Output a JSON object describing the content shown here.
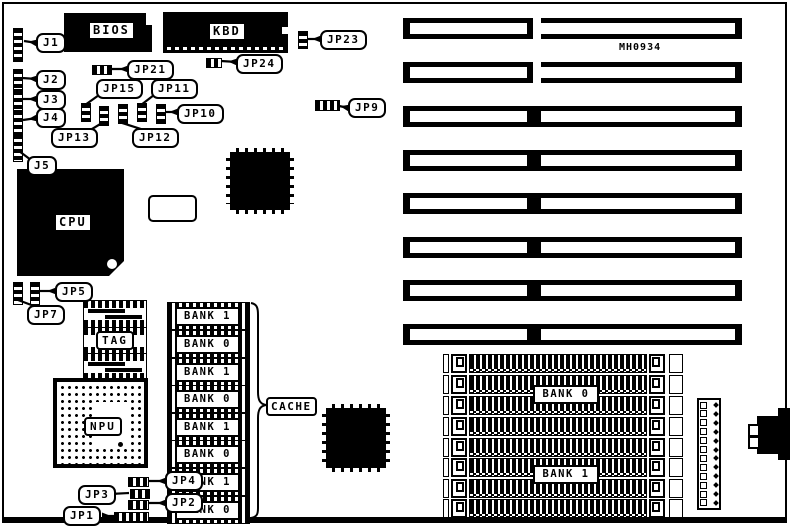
{
  "board": {
    "part_number": "MH0934"
  },
  "chips": {
    "bios": "BIOS",
    "kbd": "KBD",
    "cpu": "CPU",
    "npu": "NPU",
    "tag": "TAG",
    "cache_label": "CACHE"
  },
  "callouts": {
    "j1": "J1",
    "j2": "J2",
    "j3": "J3",
    "j4": "J4",
    "j5": "J5",
    "jp1": "JP1",
    "jp2": "JP2",
    "jp3": "JP3",
    "jp4": "JP4",
    "jp5": "JP5",
    "jp7": "JP7",
    "jp9": "JP9",
    "jp10": "JP10",
    "jp11": "JP11",
    "jp12": "JP12",
    "jp13": "JP13",
    "jp15": "JP15",
    "jp21": "JP21",
    "jp23": "JP23",
    "jp24": "JP24"
  },
  "cache_banks": [
    "BANK 1",
    "BANK 0",
    "BANK 1",
    "BANK 0",
    "BANK 1",
    "BANK 0",
    "BANK 1",
    "BANK 0"
  ],
  "simm_banks": {
    "bank0": "BANK 0",
    "bank1": "BANK 1"
  },
  "colors": {
    "ink": "#000000",
    "paper": "#ffffff"
  }
}
